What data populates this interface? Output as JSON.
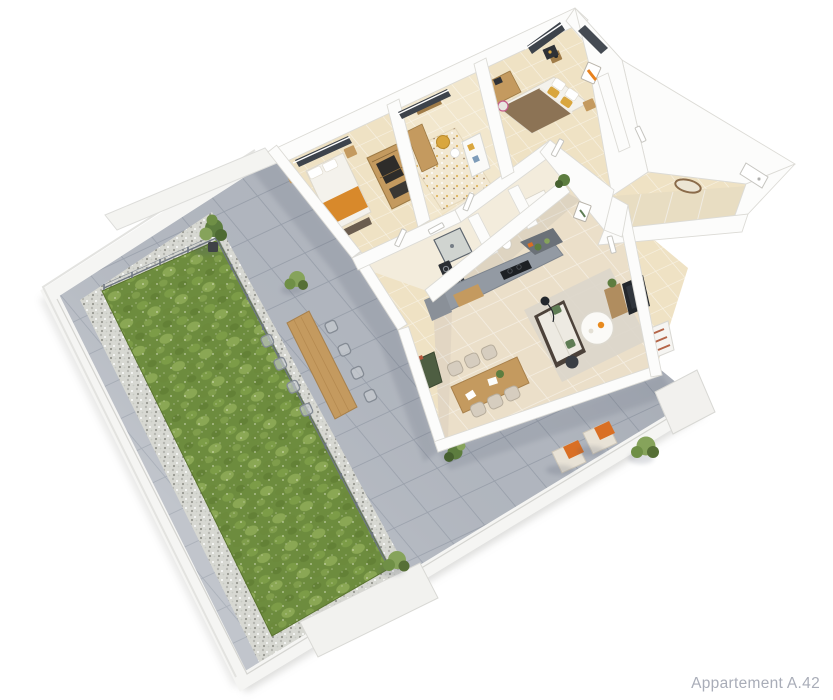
{
  "caption": {
    "text": "Appartement A.42"
  },
  "scene": {
    "description": "3D top-down architectural rendering of an apartment floor plan with a large wrap-around terrace, lawn with gravel border and wire fence, three bedrooms, bathroom and laundry, kitchen with island counter, living-dining room, entry corridor with oval mirror, outdoor dining table and lounge chairs",
    "background": "#ffffff"
  },
  "counts": {
    "bedrooms": 3,
    "indoor_dining_chairs": 6,
    "outdoor_dining_chairs": 8,
    "lounge_chairs": 2,
    "shrubs_and_trees": 5
  },
  "palette": {
    "caption_color": "#a9adb8",
    "terrace_tile": "#b5bac2",
    "terrace_joint": "#9aa1ac",
    "parapet": "#f5f5f3",
    "parapet_edge": "#d5d5d1",
    "lawn": "#6d8c3e",
    "lawn_light": "#94b05b",
    "gravel": "#d7d8d2",
    "wall": "#fcfcfb",
    "wall_edge": "#dcdbd6",
    "floor_beige": "#efe2c4",
    "floor_living": "#ebdfc9",
    "floor_bath": "#f3ecdc",
    "kitchen_gray": "#939aa3",
    "kitchen_dark": "#6b7178",
    "wood": "#c49a5f",
    "wood_dark": "#a07c48",
    "bed_white": "#f4f2ec",
    "throw_orange": "#d8892b",
    "cushion_orange": "#d96f24",
    "duvet_brown": "#8c7355",
    "pillow_yellow": "#d9a63e",
    "sofa_frame": "#4c423a",
    "sofa_cushion": "#edeae2",
    "pillow_green": "#5e7c54",
    "rug": "#dcd6cb",
    "rug_kids": "#f2e8d2",
    "tv_dark": "#23272c",
    "plant_green": "#5d7d3f",
    "plant_light": "#86a35b",
    "chair_beige": "#d6cdbf",
    "metal_gray": "#848b94",
    "credenza_green": "#4e5e42",
    "mirror_wood": "#8a6b4a",
    "shadow": "#4d5568"
  }
}
